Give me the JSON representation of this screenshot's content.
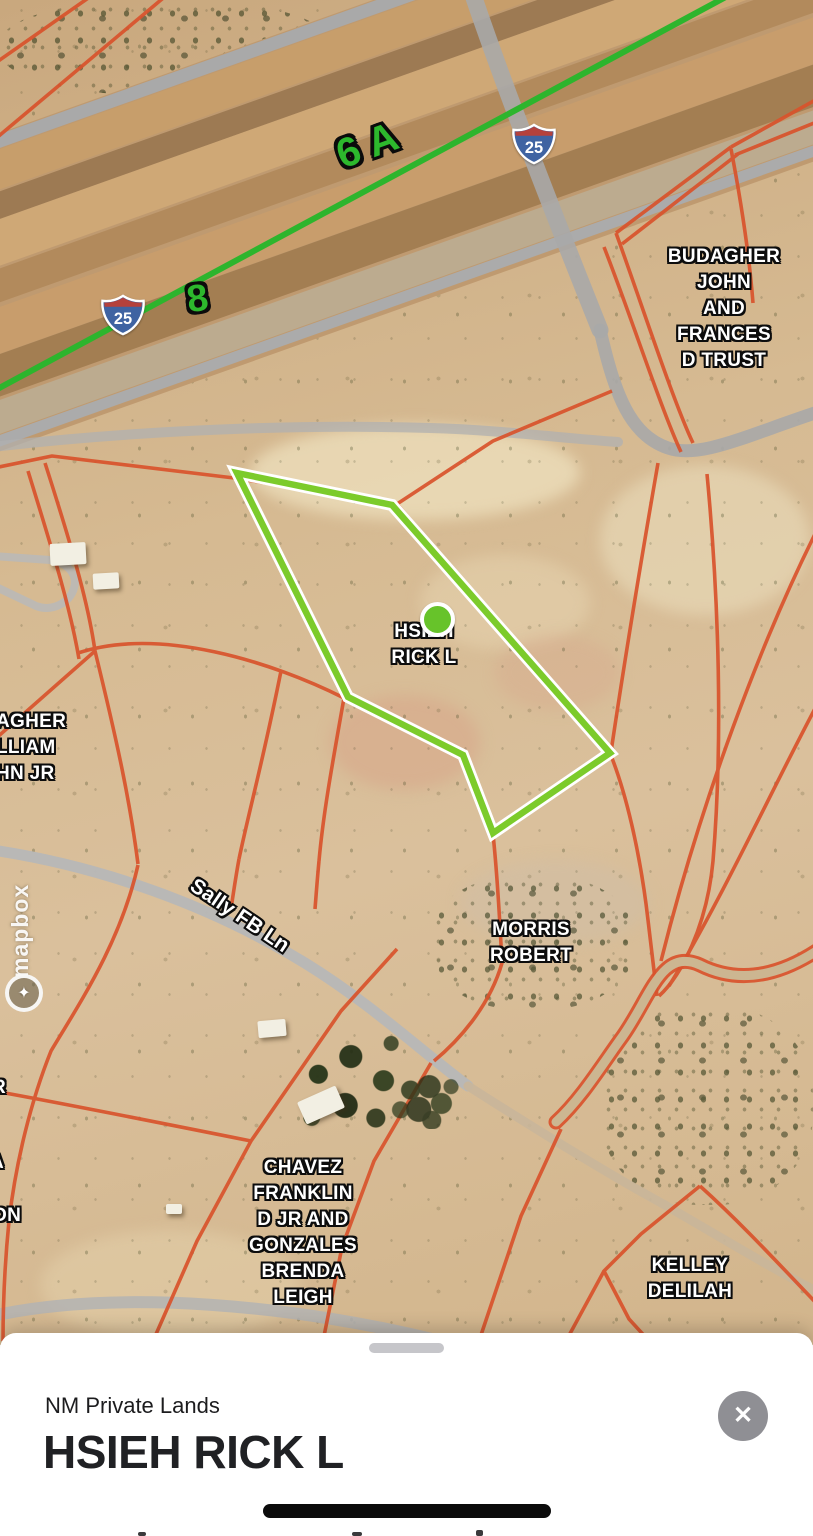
{
  "map": {
    "attribution": "mapbox",
    "attribution_logo_glyph": "✦",
    "route_overlay_labels": [
      {
        "text": "6 A"
      },
      {
        "text": "8"
      }
    ],
    "highway_shields": [
      {
        "system": "interstate",
        "number": "25"
      },
      {
        "system": "interstate",
        "number": "25"
      }
    ],
    "road_labels": [
      {
        "text": "Sally FB Ln"
      }
    ],
    "parcel_labels": [
      {
        "owner": "BUDAGHER\nJOHN\nAND\nFRANCES\nD TRUST"
      },
      {
        "owner": "HSIEH\nRICK L"
      },
      {
        "owner": "AGHER\nLLIAM\nHN JR"
      },
      {
        "owner": "MORRIS\nROBERT"
      },
      {
        "owner": "CHAVEZ\nFRANKLIN\nD JR AND\nGONZALES\nBRENDA\nLEIGH"
      },
      {
        "owner": "KELLEY\nDELILAH"
      },
      {
        "owner": "R"
      },
      {
        "owner": "A"
      },
      {
        "owner": "ON"
      }
    ],
    "colors": {
      "parcel_line": "#d9532c",
      "selected_parcel": "#7ccb2b",
      "selected_marker": "#67c32a",
      "route_line": "#2db52d",
      "route_label_green": "#2db82d",
      "shield_blue": "#3f63a2",
      "shield_red": "#b5413c"
    }
  },
  "sheet": {
    "source_label": "NM Private Lands",
    "title": "HSIEH RICK L",
    "close_icon": "✕"
  }
}
